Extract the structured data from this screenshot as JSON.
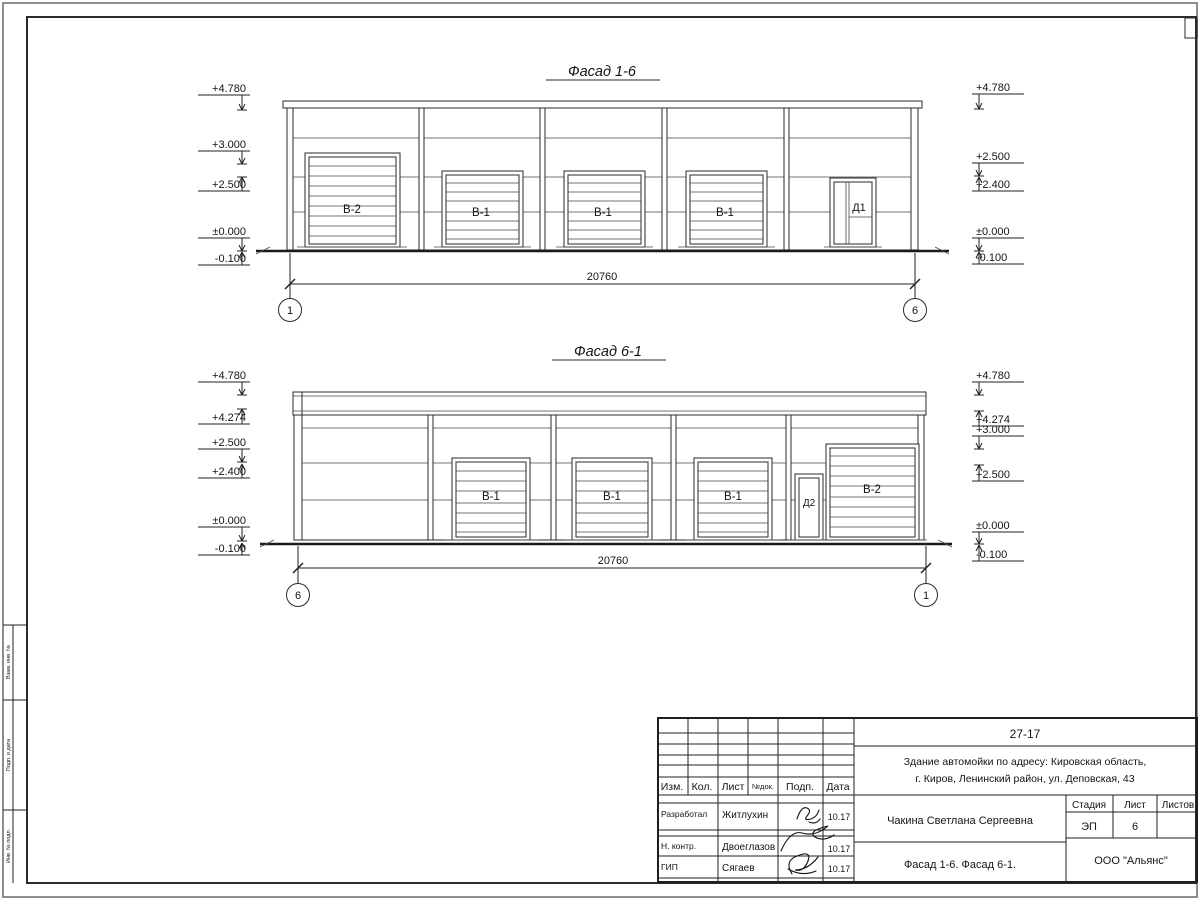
{
  "facade16": {
    "title": "Фасад 1-6",
    "dim": "20760",
    "axis_left": "1",
    "axis_right": "6",
    "gates": {
      "b2": "В-2",
      "b1": "В-1",
      "d1": "Д1"
    },
    "elev_left": [
      "+4.780",
      "+3.000",
      "+2.500",
      "±0.000",
      "-0.100"
    ],
    "elev_right": [
      "+4.780",
      "+2.500",
      "+2.400",
      "±0.000",
      "-0.100"
    ]
  },
  "facade61": {
    "title": "Фасад 6-1",
    "dim": "20760",
    "axis_left": "6",
    "axis_right": "1",
    "gates": {
      "b1": "В-1",
      "d2": "Д2",
      "b2": "В-2"
    },
    "elev_left": [
      "+4.780",
      "+4.274",
      "+2.500",
      "+2.400",
      "±0.000",
      "-0.100"
    ],
    "elev_right": [
      "+4.780",
      "+4.274",
      "+3.000",
      "+2.500",
      "±0.000",
      "-0.100"
    ]
  },
  "titleblock": {
    "doc_number": "27-17",
    "project": {
      "line1": "Здание автомойки по адресу: Кировская область,",
      "line2": "г. Киров, Ленинский район, ул. Деповская, 43"
    },
    "columns": {
      "izm": "Изм.",
      "kol": "Кол.",
      "list": "Лист",
      "ndok": "№док.",
      "podp": "Подп.",
      "data": "Дата"
    },
    "signature_rows": [
      {
        "role": "Разработал",
        "name": "Житлухин",
        "date": "10.17"
      },
      {
        "role": "Н. контр.",
        "name": "Двоеглазов",
        "date": "10.17"
      },
      {
        "role": "ГИП",
        "name": "Сягаев",
        "date": "10.17"
      }
    ],
    "author": "Чакина Светлана Сергеевна",
    "stage": {
      "label": "Стадия",
      "value": "ЭП"
    },
    "sheet": {
      "label": "Лист",
      "value": "6"
    },
    "sheets": {
      "label": "Листов",
      "value": ""
    },
    "drawing_title": "Фасад 1-6. Фасад 6-1.",
    "company": "ООО \"Альянс\""
  },
  "side_stamp": {
    "box1": "Взам. инв. №",
    "box2": "Подп. и дата",
    "box3": "Инв. № подл."
  }
}
